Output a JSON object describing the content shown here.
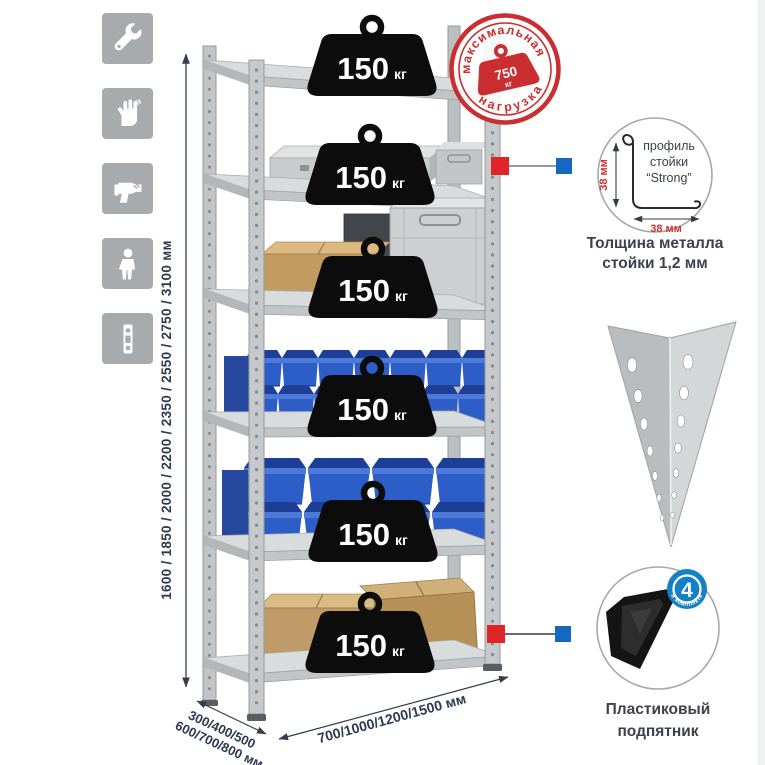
{
  "left_icons": [
    {
      "name": "wrench-icon"
    },
    {
      "name": "gloves-icon"
    },
    {
      "name": "drill-icon"
    },
    {
      "name": "person-icon"
    },
    {
      "name": "level-icon"
    }
  ],
  "shelves": [
    {
      "load": "150",
      "unit": "кг"
    },
    {
      "load": "150",
      "unit": "кг"
    },
    {
      "load": "150",
      "unit": "кг"
    },
    {
      "load": "150",
      "unit": "кг"
    },
    {
      "load": "150",
      "unit": "кг"
    },
    {
      "load": "150",
      "unit": "кг"
    }
  ],
  "stamp": {
    "arc_top": "максимальная",
    "arc_bottom": "нагрузка",
    "value": "750",
    "unit": "кг"
  },
  "height_dim": {
    "label": "1600 / 1850 / 2000 / 2200 / 2350 / 2550 / 2750 / 3100 мм"
  },
  "depth_dim": {
    "line1": "300/400/500",
    "line2": "600/700/800 мм"
  },
  "width_dim": {
    "label": "700/1000/1200/1500 мм"
  },
  "profile_detail": {
    "line1": "профиль",
    "line2": "стойки",
    "line3": "“Strong”",
    "dim_v": "38 мм",
    "dim_h": "38 мм",
    "caption1": "Толщина металла",
    "caption2": "стойки 1,2 мм"
  },
  "foot_detail": {
    "badge_value": "4",
    "badge_arc": "в комплекте",
    "caption1": "Пластиковый",
    "caption2": "подпятник"
  },
  "colors": {
    "accent_red": "#cb2e31",
    "accent_blue": "#1480c5",
    "connector_red": "#df2527",
    "connector_blue": "#1468bf",
    "bin_blue": "#2d5dc6",
    "metal_gray": "#c6c9cb",
    "text_navy": "#2c3a50",
    "weight_black": "#0c0c0c"
  }
}
